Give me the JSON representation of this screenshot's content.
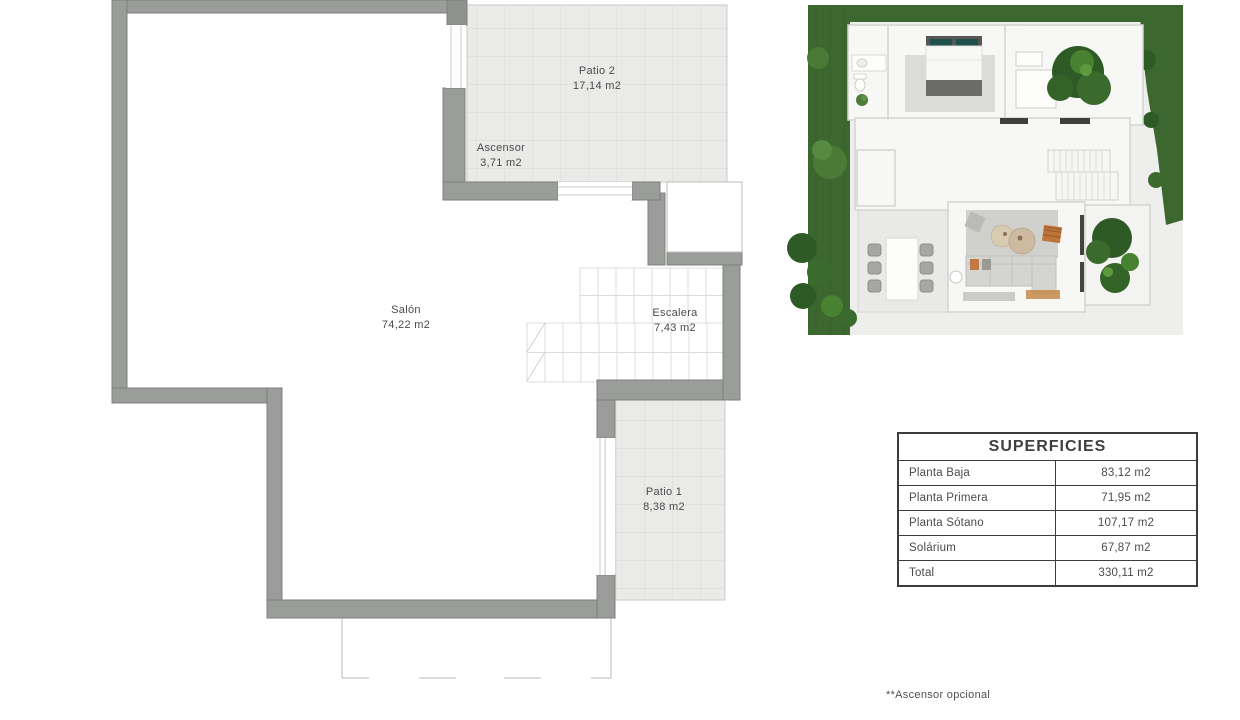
{
  "plan": {
    "rooms": [
      {
        "name": "Patio 2",
        "area": "17,14 m2"
      },
      {
        "name": "Ascensor",
        "area": "3,71 m2"
      },
      {
        "name": "Salón",
        "area": "74,22 m2"
      },
      {
        "name": "Escalera",
        "area": "7,43 m2"
      },
      {
        "name": "Patio 1",
        "area": "8,38 m2"
      }
    ],
    "colors": {
      "wall": "#9b9d9a",
      "wall_edge": "#7e807d",
      "tile_floor": "#eaebe9",
      "tile_grid": "#d8d9d7",
      "thin_line": "#b8b8b6",
      "text": "#4b4b4b"
    }
  },
  "render": {
    "colors": {
      "grass": "#3c672f",
      "tree_dark": "#2e5a25",
      "tree_mid": "#3a6a2c",
      "tree_light": "#48812f",
      "pillow_teal": "#20504b",
      "wood": "#c58a4a",
      "ground": "#eeeeec",
      "wall_white": "#f7f7f5"
    }
  },
  "superficies": {
    "title": "SUPERFICIES",
    "rows": [
      {
        "label": "Planta Baja",
        "value": "83,12 m2"
      },
      {
        "label": "Planta Primera",
        "value": "71,95 m2"
      },
      {
        "label": "Planta Sótano",
        "value": "107,17 m2"
      },
      {
        "label": "Solárium",
        "value": "67,87 m2"
      },
      {
        "label": "Total",
        "value": "330,11 m2"
      }
    ]
  },
  "footnote": "**Ascensor opcional"
}
